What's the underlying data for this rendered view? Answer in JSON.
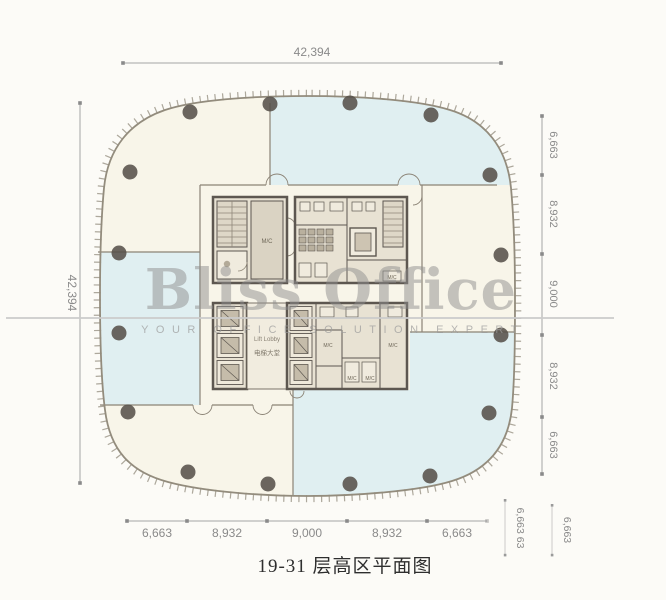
{
  "drawing": {
    "title": "19-31 层高区平面图",
    "watermark": {
      "brand": "Bliss Office",
      "tagline": "YOUR OFFICE SOLUTION EXPERT"
    },
    "dimensions": {
      "top_total": "42,394",
      "left_total": "42,394",
      "right_chain": [
        "6,663",
        "8,932",
        "9,000",
        "8,932",
        "6,663"
      ],
      "bottom_chain": [
        "6,663",
        "8,932",
        "9,000",
        "8,932",
        "6,663"
      ],
      "corner_extra": [
        "6,663 63",
        "6,663"
      ]
    },
    "core_labels": {
      "mc": "M/C",
      "lift_lobby_en": "Lift Lobby",
      "lift_lobby_cn": "电梯大堂"
    },
    "colors": {
      "zone_cyan": "#e0eff1",
      "zone_cream": "#f8f5e9",
      "core_wall": "#5d5750",
      "core_fill": "#e8e2d3",
      "outline": "#938c7d",
      "column": "#57514a",
      "dim_text": "#8a8a8a",
      "watermark_gray": "#8e8e8e",
      "title_text": "#2e2e2e"
    }
  }
}
